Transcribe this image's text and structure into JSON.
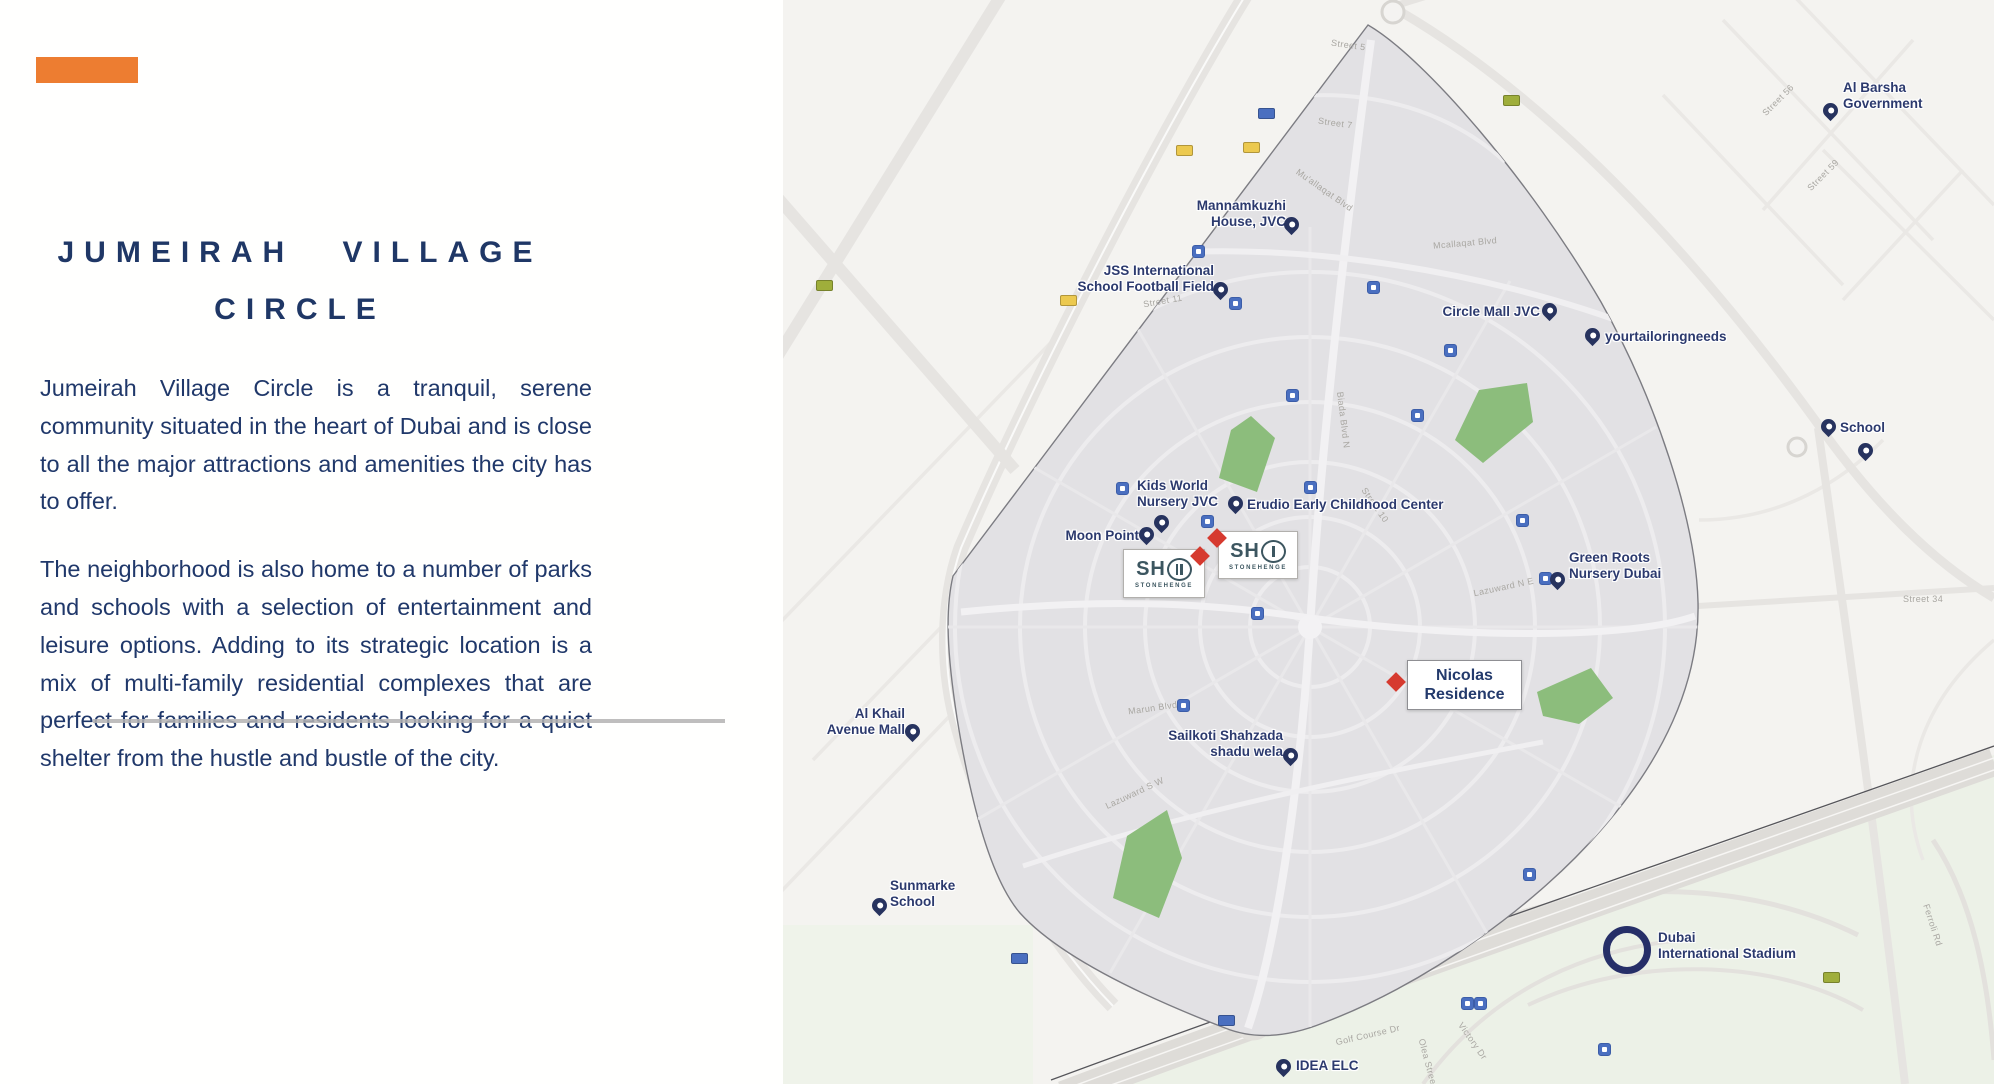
{
  "left_panel": {
    "accent_color": "#ED7D31",
    "title_line1": "JUMEIRAH VILLAGE",
    "title_line2": "CIRCLE",
    "paragraph1": "Jumeirah Village Circle is a tranquil, serene community situated in the heart of Dubai and is close to all the major attractions and amenities the city has to offer.",
    "paragraph2": "The neighborhood is also home to a number of parks and schools with a selection of entertainment and leisure options. Adding to its strategic location is a mix of multi-family residential complexes that are perfect for families and residents looking for a quiet shelter from the hustle and bustle of the city.",
    "text_color": "#20386a"
  },
  "map": {
    "colors": {
      "base": "#f4f3f0",
      "jvc_fill": "#e2e1e4",
      "boundary": "#7c7c82",
      "park_green": "#8cbd7c",
      "label_navy": "#2c3a6e",
      "pin_navy": "#27335f",
      "marker_red": "#d63a2f",
      "transit_blue": "#4a6fc0"
    },
    "pois": [
      {
        "id": "mannamkuzhi-house",
        "lines": [
          "Mannamkuzhi",
          "House, JVC"
        ],
        "text": {
          "x": 503,
          "y": 198,
          "align": "right"
        },
        "pin": {
          "x": 508,
          "y": 226
        }
      },
      {
        "id": "jss-international-school-football-field",
        "lines": [
          "JSS International",
          "School Football Field"
        ],
        "text": {
          "x": 431,
          "y": 263,
          "align": "right"
        },
        "pin": {
          "x": 437,
          "y": 291
        }
      },
      {
        "id": "circle-mall-jvc",
        "lines": [
          "Circle Mall JVC"
        ],
        "text": {
          "x": 757,
          "y": 304,
          "align": "right"
        },
        "pin": {
          "x": 766,
          "y": 312
        }
      },
      {
        "id": "yourtailoringneeds",
        "lines": [
          "yourtailoringneeds"
        ],
        "text": {
          "x": 822,
          "y": 329,
          "align": "left"
        },
        "pin": {
          "x": 809,
          "y": 337
        }
      },
      {
        "id": "al-barsha-government",
        "lines": [
          "Al Barsha",
          "Government"
        ],
        "text": {
          "x": 1060,
          "y": 80,
          "align": "left"
        },
        "pin": {
          "x": 1047,
          "y": 112
        }
      },
      {
        "id": "school",
        "lines": [
          "School"
        ],
        "text": {
          "x": 1057,
          "y": 420,
          "align": "left"
        },
        "pin": {
          "x": 1045,
          "y": 428
        }
      },
      {
        "id": "kids-world-nursery-jvc",
        "lines": [
          "Kids World",
          "Nursery JVC"
        ],
        "text": {
          "x": 354,
          "y": 478,
          "align": "left"
        },
        "pin": null
      },
      {
        "id": "moon-point",
        "lines": [
          "Moon Point"
        ],
        "text": {
          "x": 356,
          "y": 528,
          "align": "right"
        },
        "pin": {
          "x": 363,
          "y": 536
        }
      },
      {
        "id": "erudio-early-childhood-center",
        "lines": [
          "Erudio Early Childhood Center"
        ],
        "text": {
          "x": 464,
          "y": 497,
          "align": "left"
        },
        "pin": {
          "x": 452,
          "y": 505
        }
      },
      {
        "id": "green-roots-nursery-dubai",
        "lines": [
          "Green Roots",
          "Nursery Dubai"
        ],
        "text": {
          "x": 786,
          "y": 550,
          "align": "left"
        },
        "pin": {
          "x": 774,
          "y": 581
        }
      },
      {
        "id": "al-khail-avenue-mall",
        "lines": [
          "Al Khail",
          "Avenue Mall"
        ],
        "text": {
          "x": 122,
          "y": 706,
          "align": "right"
        },
        "pin": {
          "x": 129,
          "y": 733
        }
      },
      {
        "id": "sailkoti-shahzada-shadu-wela",
        "lines": [
          "Sailkoti Shahzada",
          "shadu wela"
        ],
        "text": {
          "x": 500,
          "y": 728,
          "align": "right"
        },
        "pin": {
          "x": 507,
          "y": 757
        }
      },
      {
        "id": "sunmarke-school",
        "lines": [
          "Sunmarke",
          "School"
        ],
        "text": {
          "x": 107,
          "y": 878,
          "align": "left"
        },
        "pin": {
          "x": 96,
          "y": 907
        }
      },
      {
        "id": "idea-elc",
        "lines": [
          "IDEA ELC"
        ],
        "text": {
          "x": 513,
          "y": 1058,
          "align": "left"
        },
        "pin": {
          "x": 500,
          "y": 1068
        }
      }
    ],
    "extra_pins": [
      {
        "id": "school-second-pin",
        "x": 1082,
        "y": 452
      },
      {
        "id": "kids-world-pin",
        "x": 378,
        "y": 524
      }
    ],
    "stadium": {
      "lines": [
        "Dubai",
        "International Stadium"
      ],
      "ring": {
        "x": 844,
        "y": 950
      },
      "text": {
        "x": 875,
        "y": 930
      }
    },
    "sho_boxes": [
      {
        "id": "sho-stonehenge-2",
        "sh": "SH",
        "bars": 2,
        "caption": "STONEHENGE",
        "x": 340,
        "y": 549,
        "w": 80,
        "h": 47,
        "diamond": {
          "x": 417,
          "y": 556
        }
      },
      {
        "id": "sho-stonehenge-1",
        "sh": "SH",
        "bars": 1,
        "caption": "STONEHENGE",
        "x": 435,
        "y": 531,
        "w": 78,
        "h": 46,
        "diamond": {
          "x": 434,
          "y": 538
        }
      }
    ],
    "nicolas_residence": {
      "lines": [
        "Nicolas",
        "Residence"
      ],
      "x": 624,
      "y": 660,
      "w": 113,
      "h": 48,
      "diamond": {
        "x": 613,
        "y": 682
      }
    },
    "transit_squares": [
      {
        "x": 339,
        "y": 488
      },
      {
        "x": 424,
        "y": 521
      },
      {
        "x": 527,
        "y": 487
      },
      {
        "x": 509,
        "y": 395
      },
      {
        "x": 634,
        "y": 415
      },
      {
        "x": 474,
        "y": 613
      },
      {
        "x": 739,
        "y": 520
      },
      {
        "x": 762,
        "y": 578
      },
      {
        "x": 415,
        "y": 251
      },
      {
        "x": 452,
        "y": 303
      },
      {
        "x": 590,
        "y": 287
      },
      {
        "x": 667,
        "y": 350
      },
      {
        "x": 746,
        "y": 874
      },
      {
        "x": 821,
        "y": 1049
      },
      {
        "x": 684,
        "y": 1003
      },
      {
        "x": 697,
        "y": 1003
      },
      {
        "x": 400,
        "y": 705
      }
    ],
    "route_shields": [
      {
        "x": 400,
        "y": 150,
        "c": "yellow"
      },
      {
        "x": 284,
        "y": 300,
        "c": "yellow"
      },
      {
        "x": 467,
        "y": 147,
        "c": "yellow"
      },
      {
        "x": 727,
        "y": 100,
        "c": "green"
      },
      {
        "x": 40,
        "y": 285,
        "c": "green"
      },
      {
        "x": 1047,
        "y": 977,
        "c": "green"
      },
      {
        "x": 482,
        "y": 113,
        "c": "blue"
      },
      {
        "x": 235,
        "y": 958,
        "c": "blue"
      },
      {
        "x": 442,
        "y": 1020,
        "c": "blue"
      }
    ],
    "streets": [
      {
        "t": "Street 5",
        "x": 548,
        "y": 40,
        "r": 8
      },
      {
        "t": "Street 7",
        "x": 535,
        "y": 118,
        "r": 8
      },
      {
        "t": "Mu'allaqat Blvd",
        "x": 508,
        "y": 185,
        "r": 35
      },
      {
        "t": "Mcallaqat Blvd",
        "x": 650,
        "y": 238,
        "r": -5
      },
      {
        "t": "Street 11",
        "x": 360,
        "y": 296,
        "r": -10
      },
      {
        "t": "Biada Blvd N",
        "x": 532,
        "y": 415,
        "r": 83
      },
      {
        "t": "Street 10",
        "x": 572,
        "y": 500,
        "r": 55
      },
      {
        "t": "Lazuward N E",
        "x": 690,
        "y": 582,
        "r": -12
      },
      {
        "t": "Lazuward S W",
        "x": 320,
        "y": 788,
        "r": -25
      },
      {
        "t": "Marun Blvd",
        "x": 345,
        "y": 703,
        "r": -8
      },
      {
        "t": "Street 34",
        "x": 1120,
        "y": 594,
        "r": 0
      },
      {
        "t": "Street 56",
        "x": 975,
        "y": 95,
        "r": -45
      },
      {
        "t": "Street 59",
        "x": 1020,
        "y": 170,
        "r": -45
      },
      {
        "t": "Golf Course Dr",
        "x": 552,
        "y": 1030,
        "r": -13
      },
      {
        "t": "Victory Dr",
        "x": 668,
        "y": 1036,
        "r": 55
      },
      {
        "t": "Olea Street",
        "x": 620,
        "y": 1058,
        "r": 75
      },
      {
        "t": "Ferroli Rd",
        "x": 1128,
        "y": 920,
        "r": 72
      }
    ]
  }
}
